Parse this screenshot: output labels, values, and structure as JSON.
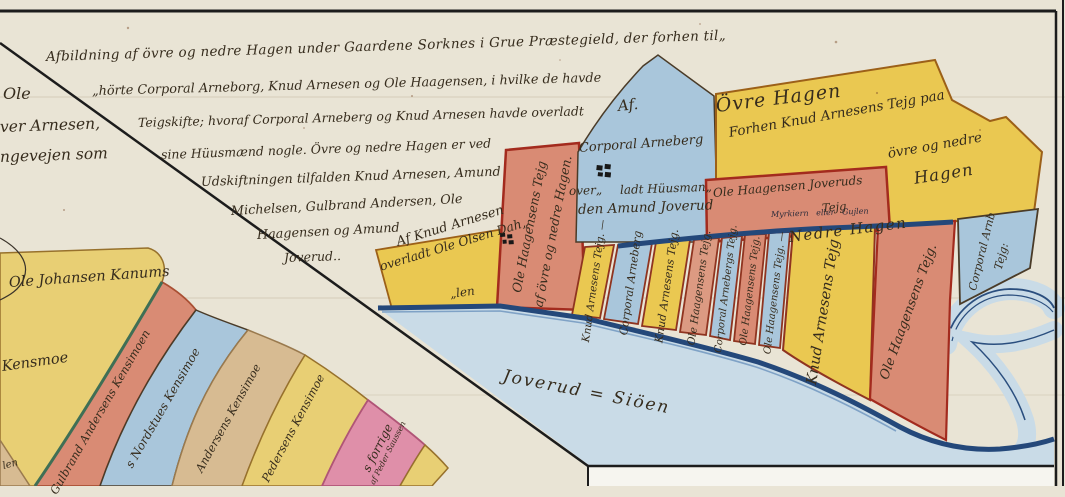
{
  "header": {
    "lines": [
      "Afbildning af övre og nedre Hagen under Gaardene Sorknes i Grue Præstegield, der forhen til„",
      "„hörte Corporal Arneborg, Knud Arnesen og Ole Haagensen, i hvilke de havde",
      "Teigskifte; hvoraf Corporal Arneberg og Knud Arnesen havde overladt",
      "sine Hüusmænd nogle.    Övre og nedre Hagen er ved",
      "Udskiftningen tilfalden Knud Arnesen, Amund",
      "Michelsen, Gulbrand Andersen, Ole",
      "Haagensen og Amund",
      "Joverud.."
    ],
    "left_fragments": [
      "Ole",
      "ver Arnesen,",
      "ngevejen som"
    ]
  },
  "regions": {
    "ovre_hagen_title": "Övre Hagen",
    "nedre_hagen_title": "Nedre Hagen",
    "lake_label": "Joverud = Siöen",
    "stream_label": "Myrkiern eller Gujlen"
  },
  "parcels": {
    "arneberg_blue": {
      "lines": [
        "Af.",
        "Corporal Arneberg",
        "over„",
        "ladt Hüusman„",
        "den Amund Joverud"
      ]
    },
    "knud_ovre": {
      "line1": "Forhen Knud Arnesens Tejg paa",
      "line2": "övre og nedre",
      "line3": "Hagen"
    },
    "joverud_red": {
      "line1": "Ole Haagensen Joveruds",
      "line2": "Tejg"
    },
    "haagensen_tall": {
      "line1": "Ole Haagensens Tejg",
      "line2": "af övre og nedre Hagen."
    },
    "dahlen_yellow": {
      "line1": "Af Knud Arnesen",
      "line2": "overladt Ole Olsen Dah„",
      "line3": "„len"
    }
  },
  "strips": [
    {
      "label": "Knud Arnesens Tejg. —",
      "color": "yellow"
    },
    {
      "label": "Corporal Arneberg",
      "color": "blue"
    },
    {
      "label": "Knud Arnesens Tejg.",
      "color": "yellow"
    },
    {
      "label": "Ole Haagensens Tejg.",
      "color": "salmon"
    },
    {
      "label": "Corporal Arnebergs Tejg.",
      "color": "blue"
    },
    {
      "label": "Ole Haagensens Tejg.",
      "color": "salmon"
    },
    {
      "label": "Ole Haagensens Tejg. —",
      "color": "blue"
    },
    {
      "label": "Knud Arnesens Tejg",
      "color": "yellow"
    },
    {
      "label": "Ole Haagensens Tejg.",
      "color": "salmon"
    },
    {
      "label1": "Corporal Arnb",
      "label2": "Tejg:",
      "color": "blue"
    }
  ],
  "kensmoe": {
    "parcel_line1": "Ole Johansen Kanums",
    "parcel_line2": "Kensmoe",
    "strips": [
      {
        "label": "Gulbrand Andersens Kensimoen",
        "color": "salmon"
      },
      {
        "label": "s Nordstues Kensimoe",
        "color": "blue"
      },
      {
        "label": "Andersens Kensimoe",
        "color": "tan"
      },
      {
        "label": "Pedersens Kensimoe",
        "color": "yellow"
      },
      {
        "label1": "s forrige",
        "label2": "af Peder Saussen",
        "color": "pink"
      },
      {
        "label": "len",
        "color": "tan"
      }
    ]
  },
  "colors": {
    "paper": "#e9e4d5",
    "yellow": "#eac851",
    "yellow_soft": "#e8cf74",
    "salmon": "#d98b74",
    "blue_parcel": "#a9c6db",
    "lake": "#c9dbe7",
    "navy_shore": "#24487a",
    "pink": "#df8fa9",
    "tan": "#d7bb92",
    "ink": "#362c1d",
    "parcel_border_red": "#a32b1e",
    "frame": "#1c1c1c"
  }
}
